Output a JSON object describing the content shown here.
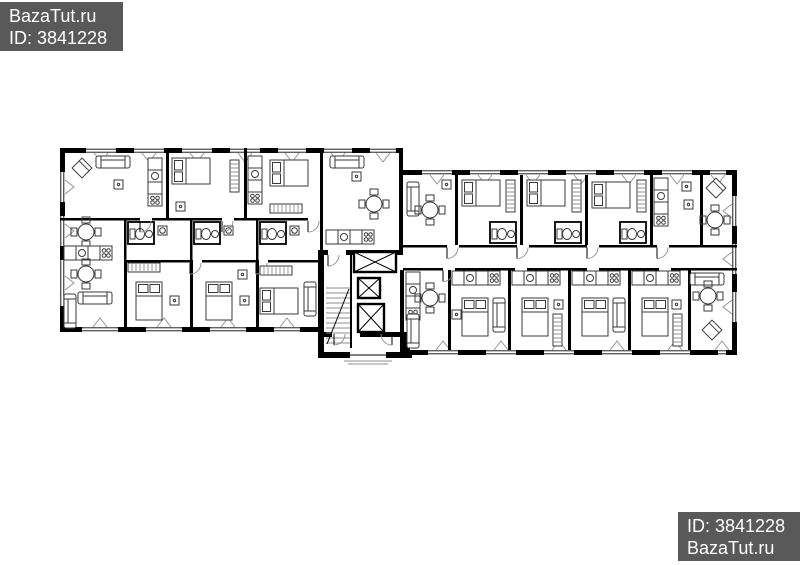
{
  "page": {
    "width": 800,
    "height": 565,
    "background": "#ffffff"
  },
  "watermarks": {
    "background": "#595959",
    "text_color": "#ffffff",
    "top_left": {
      "line1": "BazaTut.ru",
      "line2": "ID: 3841228"
    },
    "bottom_right": {
      "line1": "ID: 3841228",
      "line2": "BazaTut.ru"
    }
  },
  "floor_plan": {
    "kind": "residential-building-floor-plan",
    "wall_color": "#000000",
    "furniture_color": "#3a3a3a",
    "background": "#ffffff",
    "wings": 2,
    "elevator_count": 3,
    "stairwell_count": 1,
    "icons": [
      "bed-icon",
      "sofa-icon",
      "dining-table-icon",
      "kitchen-counter-icon",
      "wardrobe-icon",
      "toilet-icon",
      "sink-icon",
      "washing-machine-icon",
      "door-swing-icon",
      "window-icon",
      "elevator-icon",
      "stairs-icon",
      "armchair-icon"
    ]
  }
}
